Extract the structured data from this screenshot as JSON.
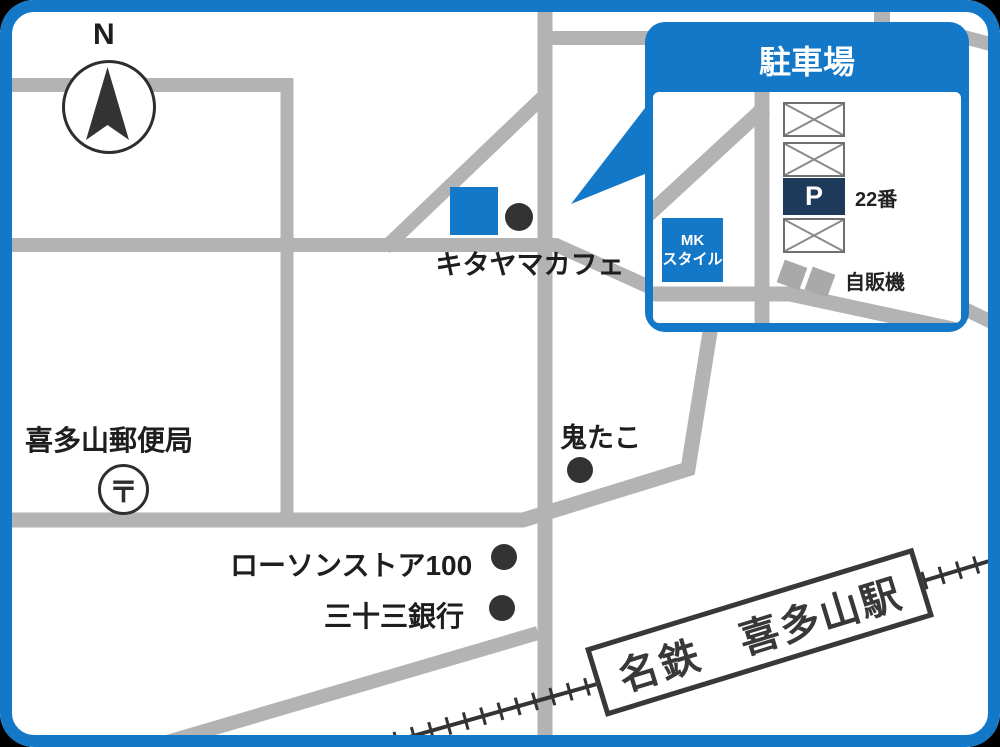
{
  "colors": {
    "accent_blue": "#1478C8",
    "road_gray": "#B3B3B3",
    "rail_dark": "#333333",
    "parking_navy": "#1E3A5A"
  },
  "compass": {
    "north_label": "N"
  },
  "map_labels": {
    "cafe": "キタヤマカフェ",
    "post_office": "喜多山郵便局",
    "post_office_symbol": "〒",
    "takoyaki_shop": "鬼たこ",
    "convenience_store": "ローソンストア100",
    "bank": "三十三銀行",
    "station": "名鉄　喜多山駅"
  },
  "parking_inset": {
    "title": "駐車場",
    "building_line1": "MK",
    "building_line2": "スタイル",
    "parking_symbol": "P",
    "parking_number": "22番",
    "vending_label": "自販機"
  }
}
